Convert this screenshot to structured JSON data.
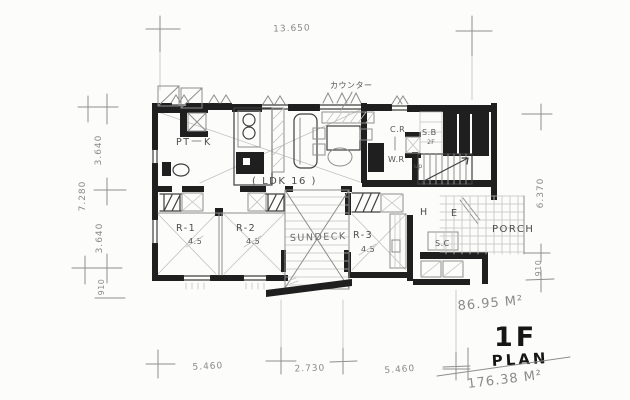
{
  "palette": {
    "paper": "#fcfcfa",
    "pencil": "#8e8e8e",
    "ink": "#1f1f1f"
  },
  "titles": {
    "floor_label": "1F",
    "plan_label": "PLAN",
    "floor_area": "86.95 M²",
    "total_area": "176.38 M²"
  },
  "dimensions": {
    "top": {
      "total": "13.650"
    },
    "left": {
      "upper": "3.640",
      "total": "7.280",
      "lower": "3.640",
      "offset": "910"
    },
    "right": {
      "total": "6.370",
      "offset": "910"
    },
    "bottom": {
      "left": "5.460",
      "center": "2.730",
      "right": "5.460"
    }
  },
  "rooms": {
    "pantry": "PT",
    "kitchen": "K",
    "ldk": "( LDK 16 )",
    "closet_room": "C.R",
    "water_room": "W.R",
    "stair_box": "S.B",
    "stair_box_note": "2F",
    "stairs_up": "up",
    "hall": "H",
    "entrance": "E",
    "shoe_closet": "S.C",
    "porch": "PORCH",
    "room1": "R-1",
    "room1_size": "4.5",
    "room2": "R-2",
    "room2_size": "4.5",
    "room3": "R-3",
    "room3_size": "4.5",
    "sundeck": "SUNDECK"
  },
  "notes": {
    "counter": "カウンター"
  }
}
